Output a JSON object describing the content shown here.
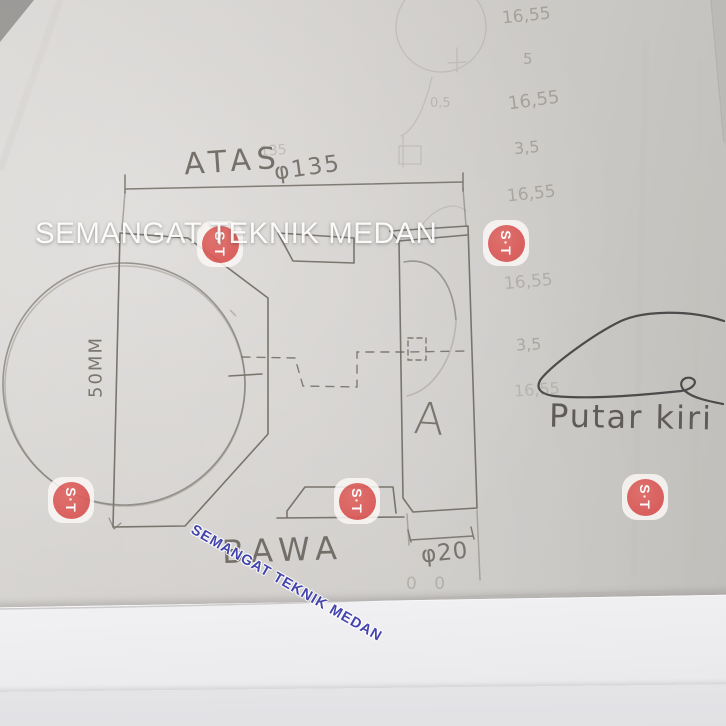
{
  "watermarks": {
    "horizontal_text": "SEMANGAT TEKNIK MEDAN",
    "diagonal_text": "SEMANGAT TEKNIK MEDAN",
    "stamp_text": "S·T",
    "stamp_color": "#da5755",
    "diagonal_color": "#4444ad",
    "horizontal_color": "#ffffff"
  },
  "drawing": {
    "labels": {
      "top_view": "ATAS",
      "bottom_view": "BAWA",
      "section": "A",
      "note": "Putar kiri"
    },
    "dimensions": {
      "outer_diameter": "φ135",
      "bore_diameter": "φ20",
      "height": "50MM"
    },
    "faint_numbers": [
      "16,55",
      "5",
      "16,55",
      "3,5",
      "16,55",
      "16,55",
      "3,5",
      "16,55"
    ],
    "ghost_marks": [
      "135",
      "0,5",
      "0 0"
    ],
    "pencil_color": "#6a645d",
    "pen_color": "#4c4a4a"
  }
}
